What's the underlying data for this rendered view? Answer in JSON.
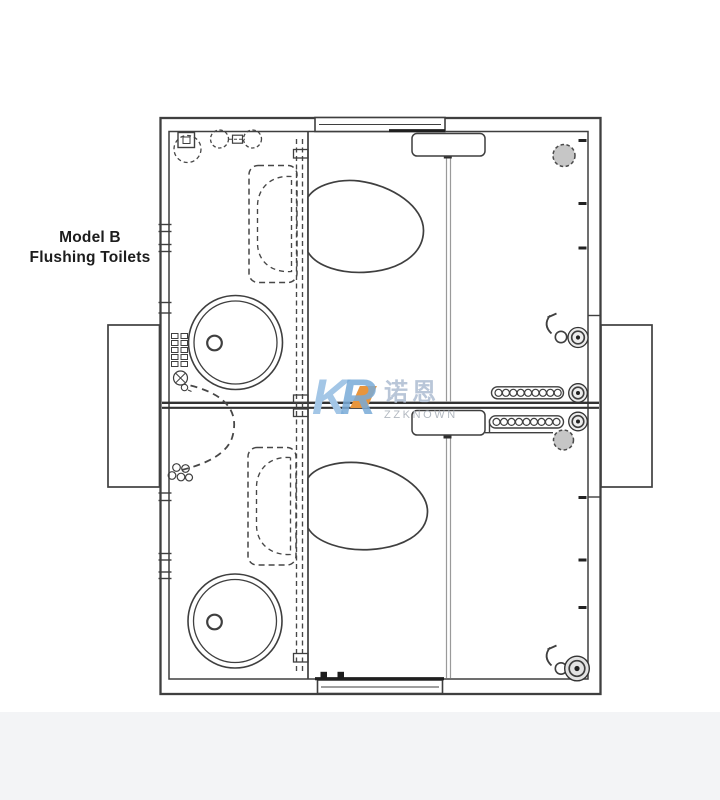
{
  "title": {
    "line1": "Model B",
    "line2": "Flushing Toilets"
  },
  "watermark": {
    "letter_k": "K",
    "letter_r": "R",
    "cjk": "诺恩",
    "brand": "ZZKNOWN",
    "colors": {
      "k_blue": "#a3c6e6",
      "r_blue": "#79abd8",
      "orange": "#e8953c",
      "cjk_gray": "#b9c6d8",
      "brand_gray": "#b2b8c0"
    }
  },
  "colors": {
    "background": "#ffffff",
    "bottom_band": "#f3f4f6",
    "line": "#3f3f3f",
    "light_gray_line": "#9a9a9a",
    "fixture_gray_fill": "#c6c6c6",
    "label_text": "#1d1d1d"
  },
  "plan": {
    "units": [
      "upper-unit",
      "lower-unit"
    ],
    "fixtures": [
      "entry-door-top",
      "entry-door-bottom",
      "steps-left",
      "steps-right",
      "toilet-upper",
      "toilet-lower",
      "wash-basin-upper",
      "wash-basin-lower",
      "counter-upper",
      "counter-lower",
      "cistern-upper",
      "cistern-lower",
      "grab-bar-upper",
      "grab-bar-lower",
      "wall-vent-upper",
      "wall-vent-lower",
      "tap-upper",
      "tap-lower",
      "pipe-knob",
      "floor-drain",
      "door-swing"
    ]
  }
}
